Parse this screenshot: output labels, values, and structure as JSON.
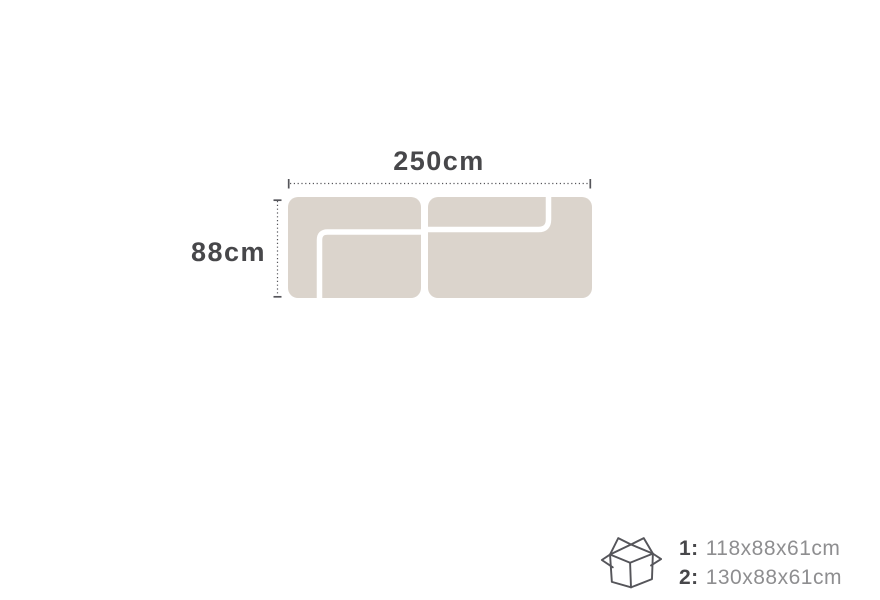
{
  "diagram": {
    "width_label": "250cm",
    "depth_label": "88cm",
    "module_count": 2
  },
  "packaging": {
    "items": [
      {
        "label": "1:",
        "value": "118x88x61cm"
      },
      {
        "label": "2:",
        "value": "130x88x61cm"
      }
    ]
  },
  "colors": {
    "sofa_fill": "#dbd4cc",
    "text_dark": "#47474a",
    "text_muted": "#8e8e90",
    "outline": "#55555a",
    "background": "#ffffff"
  }
}
